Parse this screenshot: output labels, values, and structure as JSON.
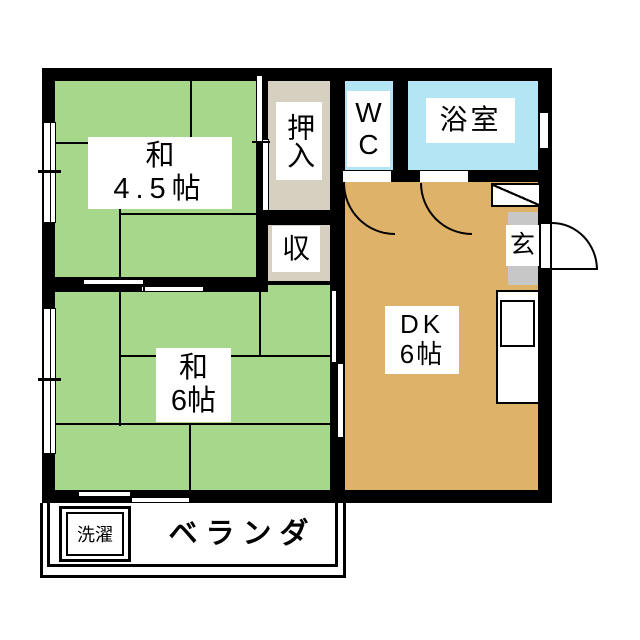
{
  "colors": {
    "wall": "#000000",
    "tatami_green": "#a7d78b",
    "dk_tan": "#dfb269",
    "closet_beige": "#d6d0c1",
    "bath_blue": "#b4e5f4",
    "genkan_gray": "#c7c7c7",
    "label_bg": "#ffffff"
  },
  "rooms": {
    "washitsu45": {
      "name": "和",
      "size": "4.5帖"
    },
    "washitsu6": {
      "name": "和",
      "size": "6帖"
    },
    "dk": {
      "name": "DK",
      "size": "6帖"
    },
    "oshiire": {
      "label": "押入"
    },
    "storage": {
      "label": "収"
    },
    "wc": {
      "line1": "W",
      "line2": "C"
    },
    "bathroom": {
      "label": "浴室"
    },
    "genkan": {
      "label": "玄"
    },
    "veranda": {
      "label": "ベランダ"
    },
    "laundry": {
      "label": "洗濯"
    }
  }
}
